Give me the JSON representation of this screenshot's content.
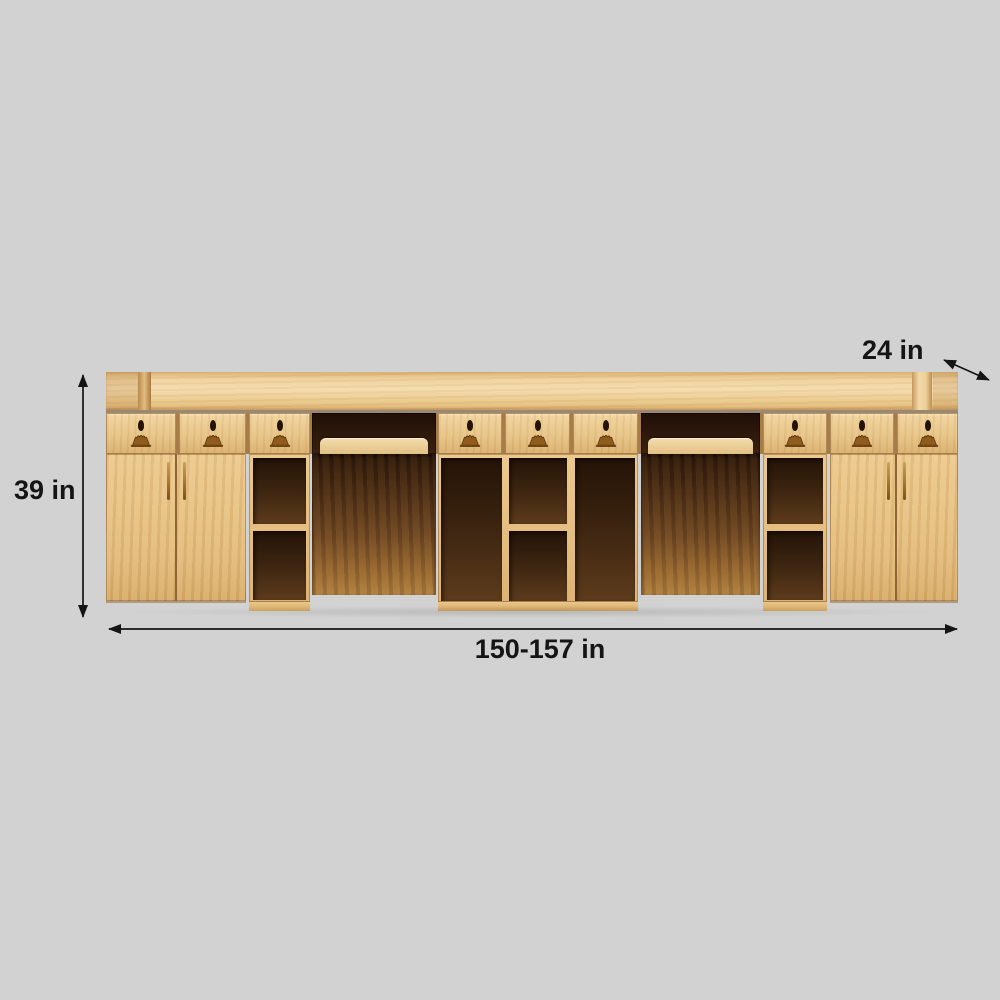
{
  "page": {
    "background_color": "#d2d2d2"
  },
  "diagram": {
    "type": "product-dimension-diagram",
    "subject": "wooden reception desk cabinet, rear view",
    "dimensions": {
      "height": {
        "label": "39 in",
        "orientation": "vertical"
      },
      "width": {
        "label": "150-157 in",
        "orientation": "horizontal"
      },
      "depth": {
        "label": "24 in",
        "orientation": "diagonal"
      }
    },
    "annotation_color": "#151515"
  },
  "furniture": {
    "drawers": 9,
    "cabinet_doors": 4,
    "open_shelf_cubbies": 8,
    "keyboard_trays": 2,
    "desk_recesses": 2,
    "colors": {
      "light_wood": "#e9c487",
      "counter_wood": "#f4dcae",
      "dark_interior": "#2c1709",
      "under_desk_wood": "#96662f",
      "handle_bronze": "#8f5c1e",
      "background": "#d2d2d2"
    }
  }
}
